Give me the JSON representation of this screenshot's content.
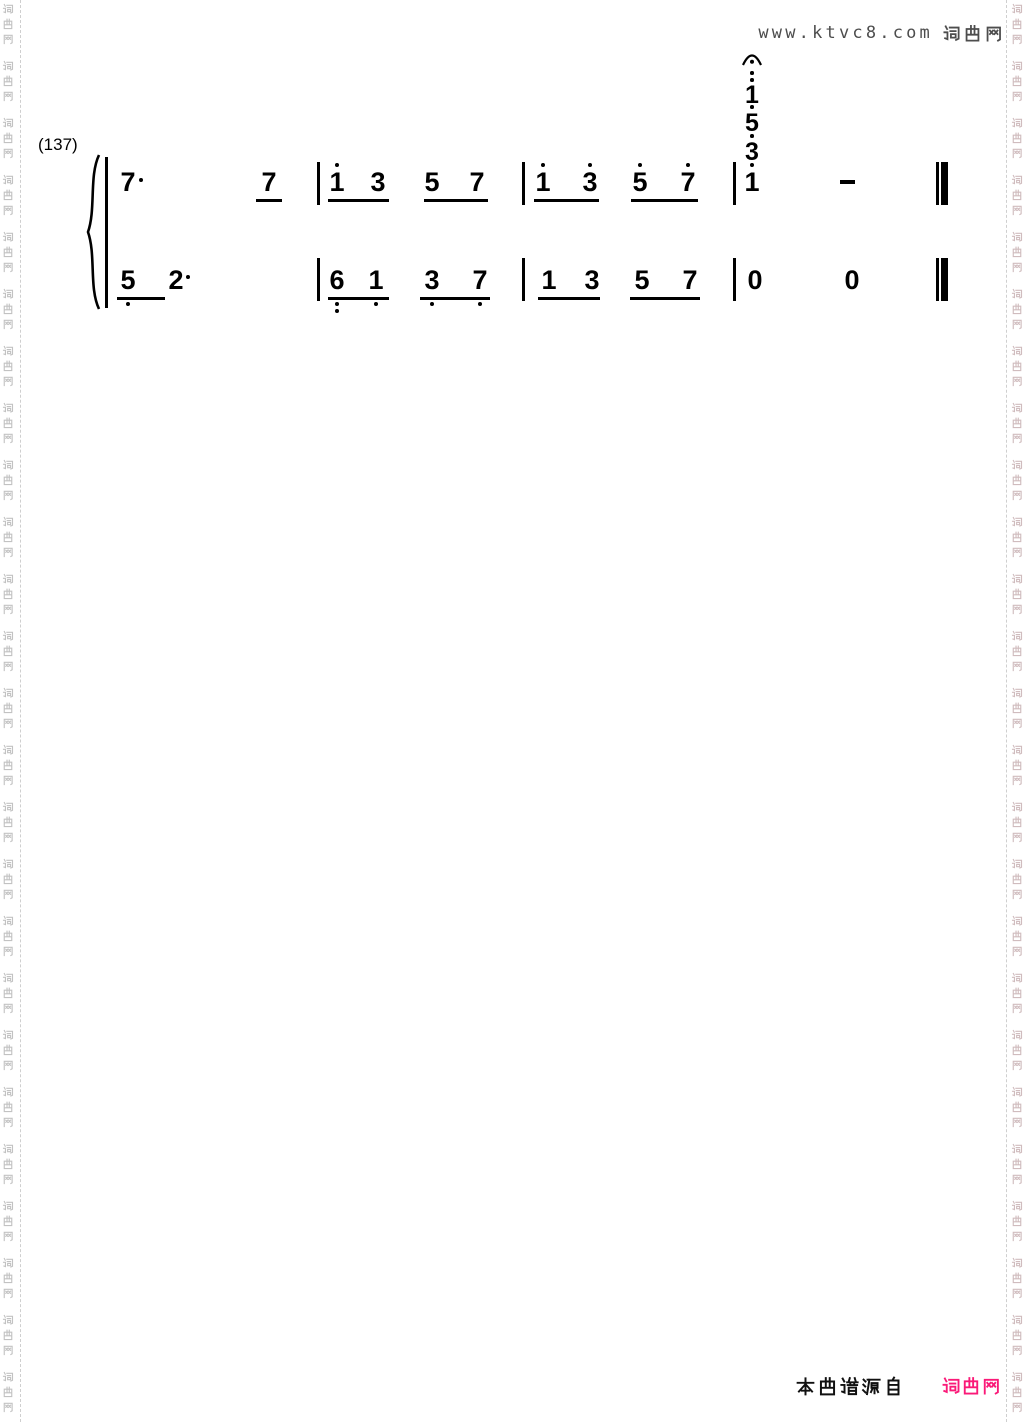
{
  "page": {
    "width": 1030,
    "height": 1422,
    "background": "#ffffff"
  },
  "header": {
    "site_url": "www.ktvc8.com",
    "site_name": "词曲网",
    "text_color": "#4d4d4d"
  },
  "watermark": {
    "text": "词曲网",
    "left_color": "#c2c2c2",
    "right_color": "#d0bcbe",
    "divider_color": "#cfcfcf"
  },
  "footer": {
    "source_label": "本曲谱源自",
    "site_name": "词曲网",
    "source_color": "#111111",
    "site_color": "#fa1a78"
  },
  "score": {
    "measure_number_label": "(137)",
    "ink_color": "#000000",
    "system": {
      "brace": {
        "x": 83,
        "y": 153,
        "w": 22,
        "h": 158
      },
      "left_bar": {
        "x": 105,
        "y": 157,
        "h": 151
      }
    },
    "treble": {
      "row_top": 169,
      "beam_y": 199,
      "barline_y": 162,
      "barline_h": 43,
      "oct_dot_above_y": 163,
      "dot_after_y": 178,
      "dot_after_dx": 13,
      "notes": [
        {
          "x": 128,
          "d": "7",
          "dot_after": true
        },
        {
          "x": 269,
          "d": "7"
        },
        {
          "x": 337,
          "d": "1",
          "oct": 1
        },
        {
          "x": 378,
          "d": "3"
        },
        {
          "x": 432,
          "d": "5"
        },
        {
          "x": 477,
          "d": "7"
        },
        {
          "x": 543,
          "d": "1",
          "oct": 1
        },
        {
          "x": 590,
          "d": "3",
          "oct": 1
        },
        {
          "x": 640,
          "d": "5",
          "oct": 1
        },
        {
          "x": 688,
          "d": "7",
          "oct": 1
        },
        {
          "x": 752,
          "d": "1",
          "oct": 1
        },
        {
          "x": 847,
          "d": "-"
        }
      ],
      "beams": [
        [
          256,
          282
        ],
        [
          328,
          389
        ],
        [
          424,
          488
        ],
        [
          534,
          599
        ],
        [
          631,
          698
        ]
      ],
      "barlines": [
        317,
        522,
        733
      ]
    },
    "bass": {
      "row_top": 267,
      "beam_y": 297,
      "barline_y": 258,
      "barline_h": 43,
      "oct_dot_below_y": 302,
      "oct_dot_below_y2": 309,
      "dot_after_y": 275,
      "dot_after_dx": 12,
      "notes": [
        {
          "x": 128,
          "d": "5",
          "oct": -1
        },
        {
          "x": 176,
          "d": "2",
          "dot_after": true
        },
        {
          "x": 337,
          "d": "6",
          "oct": -2
        },
        {
          "x": 376,
          "d": "1",
          "oct": -1
        },
        {
          "x": 432,
          "d": "3",
          "oct": -1
        },
        {
          "x": 480,
          "d": "7",
          "oct": -1
        },
        {
          "x": 549,
          "d": "1"
        },
        {
          "x": 592,
          "d": "3"
        },
        {
          "x": 642,
          "d": "5"
        },
        {
          "x": 690,
          "d": "7"
        },
        {
          "x": 755,
          "d": "0"
        },
        {
          "x": 852,
          "d": "0"
        }
      ],
      "beams": [
        [
          117,
          165
        ],
        [
          328,
          389
        ],
        [
          420,
          490
        ],
        [
          538,
          600
        ],
        [
          630,
          700
        ]
      ],
      "barlines": [
        317,
        522,
        733
      ]
    },
    "chord_stack": {
      "x": 752,
      "items": [
        {
          "d": "3",
          "top": 140,
          "dots_above": [
            134
          ]
        },
        {
          "d": "5",
          "top": 111,
          "dots_above": [
            105
          ]
        },
        {
          "d": "1",
          "top": 83,
          "dots_above": [
            78,
            71
          ]
        }
      ],
      "fermata": {
        "x": 741,
        "y": 49
      }
    },
    "final_bar": {
      "thin_x": 936,
      "thick_x": 941
    }
  }
}
